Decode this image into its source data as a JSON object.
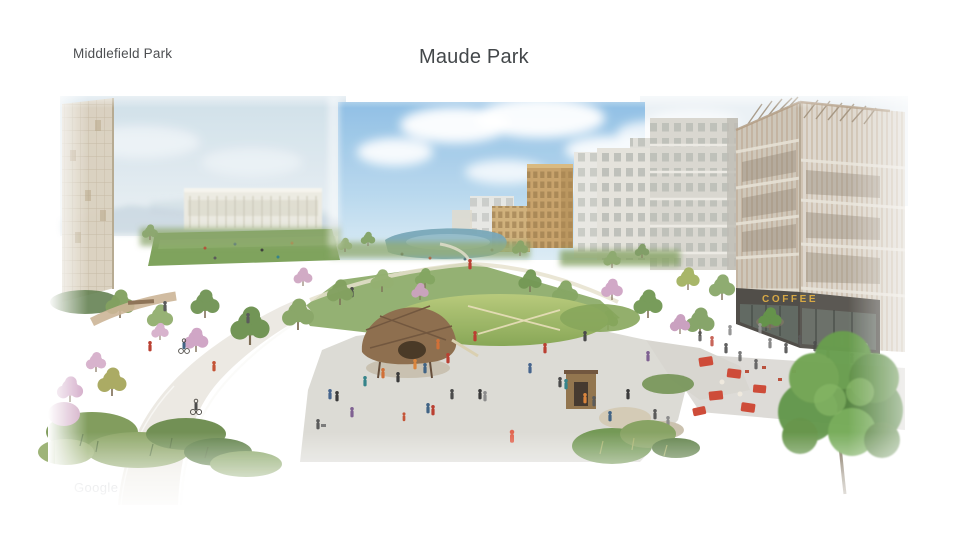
{
  "page": {
    "background": "#ffffff"
  },
  "header": {
    "location_label": "Middlefield Park",
    "title": "Maude Park"
  },
  "footer": {
    "watermark": "Google"
  },
  "scene": {
    "coffee_sign": "COFFEE",
    "colors": {
      "sky_blue": "#8cbde4",
      "sky_haze": "#d9e6ef",
      "foliage_green": "#6f9550",
      "blossom_pink": "#cfa6c2",
      "lawn_green": "#8fae58",
      "path_gray": "#ece9e2",
      "plaza_gray": "#dbdad4",
      "wood_tan": "#b59a7c",
      "coffee_sign_gold": "#d7a63e",
      "cafe_red": "#cd4531",
      "title_text": "#3c4043",
      "watermark_gray": "#c2c5c9"
    }
  }
}
